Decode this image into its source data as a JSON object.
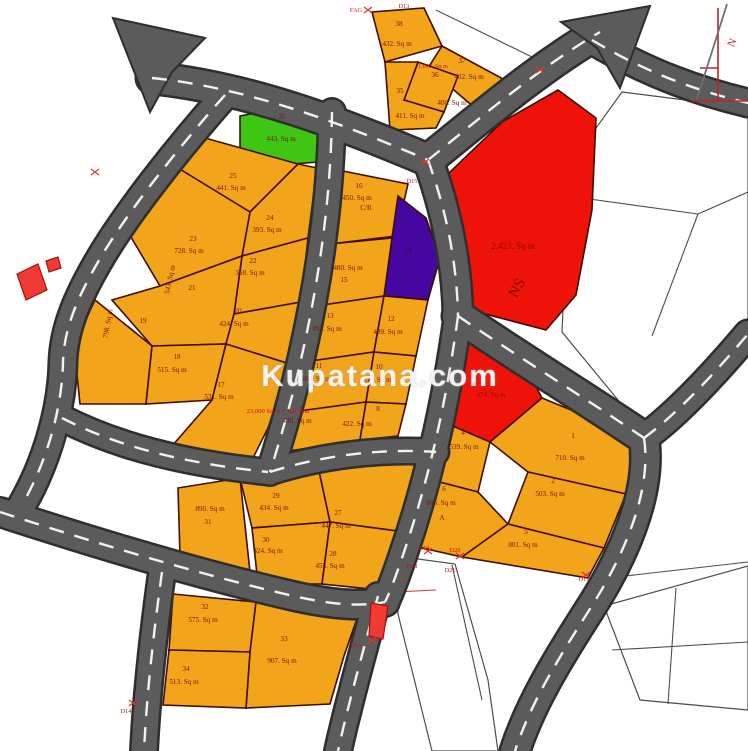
{
  "watermark": {
    "text": "Kupatana.com"
  },
  "map": {
    "colors": {
      "plot": "#F2A41B",
      "green": "#3FC614",
      "purple": "#45079F",
      "red": "#EE1208",
      "plot_stroke": "#3F0E00",
      "road": "#5B5B5B",
      "road_casing": "#2E2E2E",
      "road_dash": "#F2F2F2",
      "parcel_line": "#4D4D4D",
      "label": "#7A1404",
      "beacon": "#CC1111",
      "building": "#EF3B34",
      "building_stroke": "#A01510"
    },
    "white_areas": [
      {
        "name": "unplanned-area-northeast",
        "points": "622,92 748,108 748,330 646,434 562,332 568,196 596,128"
      },
      {
        "name": "unplanned-area-south-left",
        "points": "396,556 455,564 488,680 498,751 432,751 398,614"
      },
      {
        "name": "unplanned-area-southeast",
        "points": "604,606 748,566 748,710 640,700"
      }
    ],
    "white_lines": [
      [
        568,
        196,
        698,
        214
      ],
      [
        698,
        214,
        748,
        192
      ],
      [
        698,
        214,
        652,
        336
      ],
      [
        436,
        10,
        534,
        58
      ],
      [
        452,
        565,
        482,
        700
      ],
      [
        590,
        580,
        748,
        562
      ],
      [
        676,
        588,
        668,
        704
      ],
      [
        612,
        650,
        748,
        642
      ],
      [
        374,
        593,
        436,
        590,
        "#D23B2F"
      ]
    ],
    "plots": [
      {
        "id": "26",
        "fill": "green",
        "pts": "240,116 305,103 322,130 318,162 240,168",
        "labels": [
          [
            "26",
            282,
            119
          ],
          [
            "443. Sq m",
            281,
            141
          ]
        ]
      },
      {
        "id": "25",
        "pts": "205,138 298,164 250,212 178,168",
        "labels": [
          [
            "25",
            233,
            178
          ],
          [
            "441. Sq m",
            231,
            190
          ]
        ]
      },
      {
        "id": "24",
        "pts": "298,164 317,168 308,238 242,256 250,212",
        "labels": [
          [
            "24",
            270,
            220
          ],
          [
            "393. Sq m",
            267,
            232
          ]
        ]
      },
      {
        "id": "23",
        "pts": "178,168 250,212 242,256 160,286 122,222",
        "labels": [
          [
            "23",
            193,
            241
          ],
          [
            "728. Sq m",
            189,
            253
          ]
        ]
      },
      {
        "id": "22",
        "pts": "242,256 308,238 301,302 234,314",
        "labels": [
          [
            "22",
            253,
            263
          ],
          [
            "368. Sq m",
            250,
            275
          ]
        ]
      },
      {
        "id": "21",
        "pts": "160,286 242,256 234,314 226,344 152,346 112,300",
        "labels": [
          [
            "21",
            192,
            290
          ],
          [
            "543. Sq m",
            172,
            280,
            -78
          ]
        ]
      },
      {
        "id": "20",
        "pts": "234,314 301,302 290,364 226,344",
        "labels": [
          [
            "20",
            238,
            313
          ],
          [
            "424. Sq m",
            234,
            326
          ]
        ]
      },
      {
        "id": "19",
        "pts": "95,300 152,346 146,404 80,404 74,345",
        "labels": [
          [
            "19",
            143,
            323
          ],
          [
            "798. Sq m",
            110,
            324,
            -80
          ]
        ]
      },
      {
        "id": "18",
        "pts": "152,346 226,344 212,400 146,404",
        "labels": [
          [
            "18",
            177,
            359
          ],
          [
            "515. Sq m",
            172,
            372
          ]
        ]
      },
      {
        "id": "17",
        "pts": "226,344 290,364 268,428 252,460 172,446 212,400",
        "labels": [
          [
            "17",
            221,
            387
          ],
          [
            "531. Sq m",
            219,
            399
          ]
        ]
      },
      {
        "id": "16",
        "pts": "338,170 408,184 396,236 330,244",
        "labels": [
          [
            "16",
            359,
            188
          ],
          [
            "450. Sq m",
            357,
            200
          ],
          [
            "C/R",
            366,
            210
          ]
        ]
      },
      {
        "id": "14",
        "fill": "purple",
        "pts": "398,196 426,218 440,258 428,300 384,296 392,238",
        "labels": [
          [
            "14",
            408,
            253,
            0,
            "#2D0A44"
          ]
        ]
      },
      {
        "id": "15",
        "pts": "330,244 392,238 384,296 316,306",
        "labels": [
          [
            "480. Sq m",
            348,
            270
          ],
          [
            "15",
            344,
            282
          ]
        ]
      },
      {
        "id": "13",
        "pts": "316,306 384,296 374,352 304,362",
        "labels": [
          [
            "13",
            330,
            318
          ],
          [
            "493. Sq m",
            327,
            331
          ]
        ]
      },
      {
        "id": "12",
        "pts": "384,296 428,300 416,356 374,352",
        "labels": [
          [
            "12",
            391,
            321
          ],
          [
            "499. Sq m",
            388,
            334
          ]
        ]
      },
      {
        "id": "11",
        "pts": "304,362 374,352 366,402 292,412",
        "labels": [
          [
            "11",
            319,
            368
          ],
          [
            "480. Sq m",
            316,
            381
          ]
        ]
      },
      {
        "id": "10",
        "pts": "374,352 416,356 406,404 366,402",
        "labels": [
          [
            "10",
            379,
            369
          ],
          [
            "496. Sq m",
            377,
            382
          ]
        ]
      },
      {
        "id": "9",
        "pts": "292,412 366,402 360,440 282,452",
        "labels": [
          [
            "9",
            302,
            411
          ],
          [
            "480. Sq m",
            297,
            423
          ]
        ]
      },
      {
        "id": "8",
        "pts": "366,402 406,404 398,436 360,440",
        "labels": [
          [
            "8",
            378,
            411
          ],
          [
            "422. Sq m",
            357,
            426
          ]
        ]
      },
      {
        "id": "38",
        "pts": "372,12 424,8 442,46 385,62",
        "labels": [
          [
            "38",
            399,
            26
          ],
          [
            "432. Sq m",
            397,
            46
          ]
        ]
      },
      {
        "id": "37",
        "pts": "442,46 505,80 482,114 428,68",
        "labels": [
          [
            "37",
            462,
            63
          ],
          [
            "402. Sq m",
            469,
            79
          ]
        ]
      },
      {
        "id": "36",
        "pts": "418,62 458,76 444,112 404,100",
        "labels": [
          [
            "36",
            435,
            77
          ],
          [
            "400. Sq m",
            452,
            105
          ]
        ]
      },
      {
        "id": "35",
        "pts": "385,62 418,62 404,100 444,112 436,128 390,130",
        "labels": [
          [
            "35",
            400,
            93
          ],
          [
            "411. Sq m",
            410,
            118
          ]
        ]
      },
      {
        "id": "NS",
        "fill": "red",
        "pts": "448,174 502,122 558,90 596,118 592,210 576,295 546,330 470,310 448,235",
        "labels": [
          [
            "2,423. Sq m",
            513,
            249,
            0,
            "#8B0A04",
            9
          ],
          [
            "NS",
            521,
            290,
            -62,
            "#7A0A04",
            15
          ]
        ]
      },
      {
        "id": "7",
        "fill": "red",
        "pts": "446,340 515,346 542,398 490,442 448,424",
        "labels": [
          [
            "7",
            493,
            381,
            0,
            "#8F0D05"
          ],
          [
            "474. Sq m",
            491,
            397,
            0,
            "#8F0D05"
          ]
        ]
      },
      {
        "id": "4",
        "pts": "434,426 448,424 490,442 478,492 424,478",
        "labels": [
          [
            "4",
            463,
            435
          ],
          [
            "539. Sq m",
            464,
            449
          ]
        ]
      },
      {
        "id": "1",
        "pts": "542,398 644,440 626,494 528,472 490,442",
        "labels": [
          [
            "1",
            573,
            438
          ],
          [
            "710. Sq m",
            570,
            460
          ]
        ]
      },
      {
        "id": "2",
        "pts": "528,472 626,494 604,548 508,524",
        "labels": [
          [
            "2",
            553,
            483
          ],
          [
            "503. Sq m",
            550,
            496
          ]
        ]
      },
      {
        "id": "6",
        "pts": "424,478 478,492 508,524 462,557 396,542",
        "labels": [
          [
            "6",
            444,
            491
          ],
          [
            "806. Sq m",
            441,
            505
          ],
          [
            "A",
            442,
            520
          ]
        ]
      },
      {
        "id": "5",
        "pts": "508,524 604,548 588,578 462,557",
        "labels": [
          [
            "5",
            526,
            534
          ],
          [
            "801. Sq m",
            523,
            547
          ]
        ]
      },
      {
        "id": "31",
        "pts": "178,488 240,478 250,572 180,556",
        "labels": [
          [
            "890. Sq m",
            210,
            511
          ],
          [
            "31",
            208,
            524
          ]
        ]
      },
      {
        "id": "29",
        "pts": "240,478 318,466 330,522 252,528",
        "labels": [
          [
            "29",
            276,
            498
          ],
          [
            "434. Sq m",
            274,
            510
          ]
        ]
      },
      {
        "id": "27",
        "pts": "318,466 438,452 420,534 330,522",
        "labels": [
          [
            "27",
            338,
            515
          ],
          [
            "447. Sq m",
            336,
            528
          ]
        ]
      },
      {
        "id": "30",
        "pts": "252,528 330,522 322,584 258,584",
        "labels": [
          [
            "30",
            266,
            542
          ],
          [
            "424. Sq m",
            268,
            553
          ]
        ]
      },
      {
        "id": "28",
        "pts": "330,522 420,534 400,592 322,584",
        "labels": [
          [
            "28",
            333,
            556
          ],
          [
            "455. Sq m",
            330,
            568
          ]
        ]
      },
      {
        "id": "32",
        "pts": "173,594 256,602 250,652 169,650",
        "labels": [
          [
            "32",
            205,
            609
          ],
          [
            "575. Sq m",
            203,
            622
          ]
        ]
      },
      {
        "id": "33",
        "pts": "256,602 360,610 344,656 330,704 246,708 250,652",
        "labels": [
          [
            "33",
            284,
            641
          ],
          [
            "907. Sq m",
            282,
            663
          ]
        ]
      },
      {
        "id": "34",
        "pts": "169,650 250,652 246,708 163,705",
        "labels": [
          [
            "34",
            186,
            671
          ],
          [
            "513. Sq m",
            184,
            684
          ]
        ]
      }
    ],
    "roads": [
      {
        "name": "road-top-west",
        "d": "M 152,78 C 250,88 345,125 428,160",
        "w": 30
      },
      {
        "name": "road-ne-arrow",
        "d": "M 428,160 C 472,125 535,70 600,32",
        "w": 30
      },
      {
        "name": "road-east-top",
        "d": "M 592,40 C 650,75 702,92 748,103",
        "w": 26
      },
      {
        "name": "road-redplot-west",
        "d": "M 428,160 C 446,210 457,262 458,316",
        "w": 28
      },
      {
        "name": "road-diagonal-se",
        "d": "M 458,316 C 520,358 588,400 644,438",
        "w": 30
      },
      {
        "name": "road-right-edge",
        "d": "M 644,438 C 676,415 716,372 748,334",
        "w": 26
      },
      {
        "name": "road-southeast",
        "d": "M 644,438 C 652,490 625,555 588,612 C 556,662 530,705 515,751",
        "w": 28
      },
      {
        "name": "road-mid-vertical",
        "d": "M 458,316 C 448,390 432,470 404,552 C 396,576 390,592 385,602",
        "w": 26
      },
      {
        "name": "road-west",
        "d": "M 225,95 C 178,148 125,215 98,262 C 76,300 64,330 63,362 C 62,412 45,465 22,505",
        "w": 26
      },
      {
        "name": "road-mid-column",
        "d": "M 332,112 C 331,195 320,275 302,355 C 292,400 280,440 270,472",
        "w": 25
      },
      {
        "name": "road-cross",
        "d": "M 270,472 C 320,456 380,448 436,452",
        "w": 24
      },
      {
        "name": "road-south-17",
        "d": "M 62,418 C 120,448 190,464 268,472",
        "w": 24
      },
      {
        "name": "road-bottom-west",
        "d": "M 0,512 C 80,538 200,575 298,597 C 340,606 365,606 385,602",
        "w": 27
      },
      {
        "name": "road-bottom-left-branch",
        "d": "M 162,572 C 154,630 147,690 144,751",
        "w": 25
      },
      {
        "name": "road-bottom-mid-branch",
        "d": "M 378,596 C 364,648 348,705 338,751",
        "w": 25
      }
    ],
    "arrowheads": [
      {
        "name": "road-arrow-northwest",
        "points": "113,18 205,38 172,72 150,112"
      },
      {
        "name": "road-arrow-northeast",
        "points": "650,6 561,22 597,48 620,88"
      }
    ],
    "buildings": [
      {
        "name": "building-west-large",
        "points": "17,274 38,264 47,290 26,300"
      },
      {
        "name": "building-west-small",
        "points": "46,261 58,257 61,268 49,272"
      },
      {
        "name": "building-south",
        "points": "371,603 388,606 383,639 369,636"
      }
    ],
    "beacons": [
      [
        "FAG",
        356,
        12
      ],
      [
        "D13",
        404,
        8
      ],
      [
        "D15",
        412,
        183
      ],
      [
        "D19",
        424,
        550
      ],
      [
        "D18",
        412,
        568
      ],
      [
        "D20",
        455,
        552
      ],
      [
        "D21",
        450,
        572
      ],
      [
        "D17",
        584,
        581
      ],
      [
        "D16",
        356,
        647
      ],
      [
        "D14",
        126,
        713
      ]
    ],
    "marks": [
      [
        425,
        162
      ],
      [
        540,
        70
      ],
      [
        428,
        551
      ],
      [
        460,
        556
      ],
      [
        586,
        575
      ],
      [
        372,
        640
      ],
      [
        133,
        703
      ],
      [
        95,
        172
      ],
      [
        368,
        10
      ]
    ],
    "annotations": [
      [
        "1,093. Sq m",
        433,
        68,
        "#CC1111",
        6.2
      ],
      [
        "23,000 Sq m = full land",
        278,
        413,
        "#CC1111",
        6.6
      ]
    ],
    "north_arrow": {
      "lines": [
        [
          718,
          8,
          718,
          100,
          "#C22222",
          1.6
        ],
        [
          692,
          101,
          748,
          101,
          "#C22222",
          1.6
        ],
        [
          700,
          68,
          718,
          68,
          "#C22222",
          1.4
        ],
        [
          697,
          99,
          727,
          4,
          "#6F6F6F",
          1.8
        ]
      ],
      "label": [
        "N",
        735,
        44,
        -65,
        "#C22222",
        11
      ]
    }
  }
}
